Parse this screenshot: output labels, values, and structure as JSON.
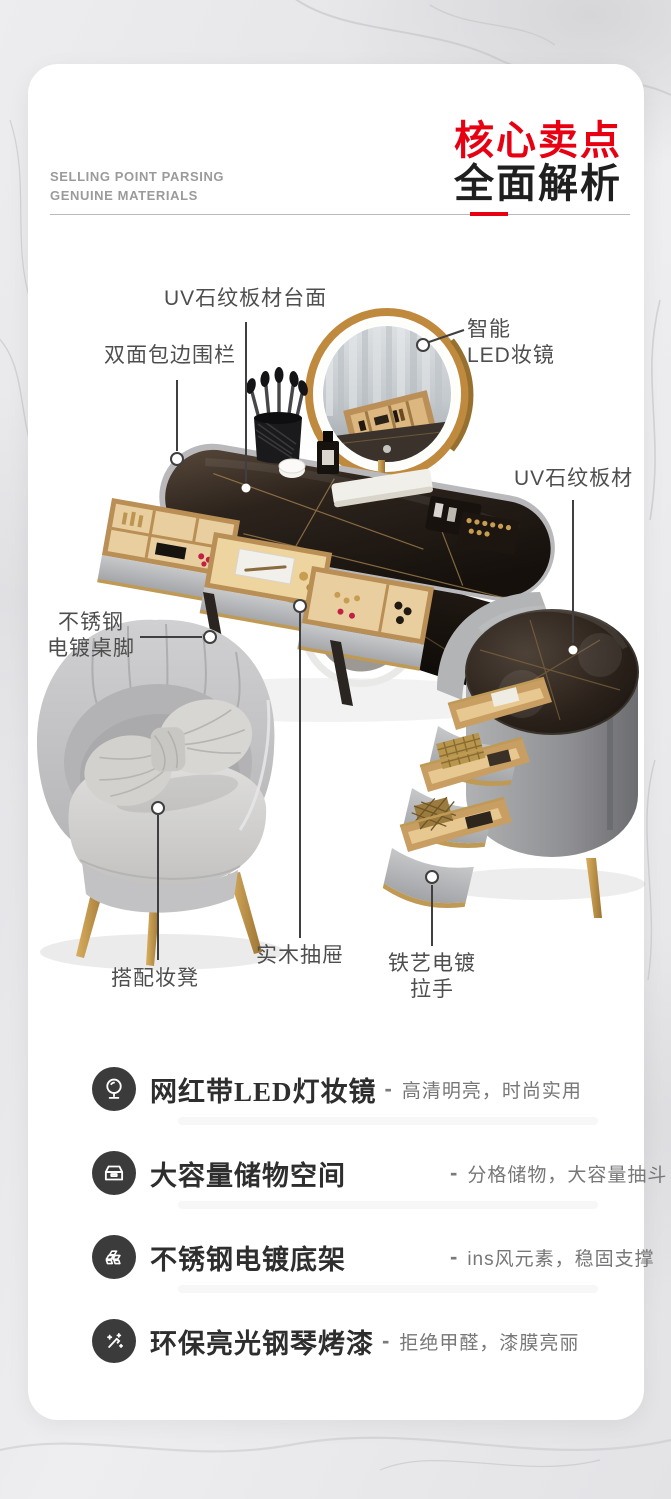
{
  "header": {
    "subtitle_line1": "SELLING POINT PARSING",
    "subtitle_line2": "GENUINE MATERIALS",
    "title_red": "核心卖点",
    "title_black": "全面解析"
  },
  "colors": {
    "accent_red": "#e60012",
    "feature_icon_bg": "#3b3b3b",
    "callout_text": "#4e4e4e",
    "gold": "#c79d52",
    "tabletop_dark": "#241c16",
    "chair_gray": "#c9c9cb"
  },
  "callouts": {
    "tabletop": {
      "label": "UV石纹板材台面"
    },
    "fence": {
      "label": "双面包边围栏"
    },
    "led_mirror": {
      "label_line1": "智能",
      "label_line2": "LED妆镜"
    },
    "side_board": {
      "label": "UV石纹板材"
    },
    "table_legs": {
      "label_line1": "不锈钢",
      "label_line2": "电镀桌脚"
    },
    "stool": {
      "label": "搭配妆凳"
    },
    "drawer": {
      "label": "实木抽屉"
    },
    "handle": {
      "label_line1": "铁艺电镀",
      "label_line2": "拉手"
    }
  },
  "features": [
    {
      "icon": "vanity-mirror-icon",
      "title": "网红带LED灯妆镜",
      "sep": "-",
      "desc": "高清明亮，时尚实用"
    },
    {
      "icon": "storage-drawer-icon",
      "title": "大容量储物空间",
      "sep": "-",
      "desc": "分格储物，大容量抽斗"
    },
    {
      "icon": "gold-bars-icon",
      "title": "不锈钢电镀底架",
      "sep": "-",
      "desc": "ins风元素，稳固支撑"
    },
    {
      "icon": "paint-wand-icon",
      "title": "环保亮光钢琴烤漆",
      "sep": "-",
      "desc": "拒绝甲醛，漆膜亮丽"
    }
  ]
}
